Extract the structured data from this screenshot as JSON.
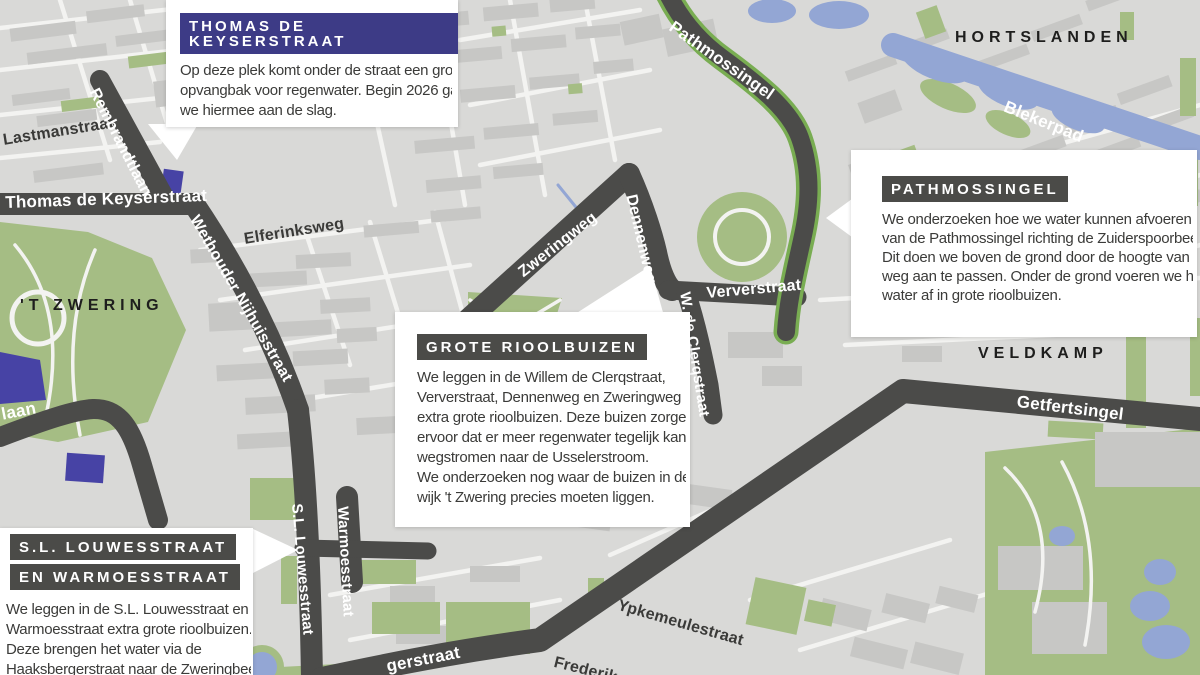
{
  "colors": {
    "map_background": "#d9d9d7",
    "buildings": "#c7c7c5",
    "streets_light": "#f3f3f1",
    "parks_green": "#a5bd84",
    "singel_edge_green": "#79ad52",
    "water_blue": "#93a6d4",
    "road_highlight_dark": "#4b4b49",
    "project_purple": "#4743a5",
    "header_navy": "#3d3b86",
    "header_gray": "#4b4b48",
    "body_text": "#3b3b39"
  },
  "districts": {
    "hortslanden": "HORTSLANDEN",
    "t_zwering": "'T ZWERING",
    "veldkamp": "VELDKAMP"
  },
  "street_labels": {
    "lastmanstraat": "Lastmanstraat",
    "rembrandtlaan": "Rembrandtlaan",
    "thomas_de_keyserstraat": "Thomas de Keyserstraat",
    "wethouder_nijhuisstraat": "Wethouder Nijhuisstraat",
    "elferinksweg": "Elferinksweg",
    "zweringweg": "Zweringweg",
    "dennenweg": "Dennenweg",
    "w_de_clerqstraat": "W. de Clerqstraat",
    "ververstraat": "Ververstraat",
    "pathmossingel": "Pathmossingel",
    "blekerpad": "Blekerpad",
    "getfertsingel": "Getfertsingel",
    "sl_louwesstraat": "S.L. Louwesstraat",
    "warmoesstraat": "Warmoesstraat",
    "ypkemeulestraat": "Ypkemeulestraat",
    "laan_fragment": "laan",
    "haaksbergerstraat_fragment": "gerstraat",
    "frederik_fragment": "Frederik"
  },
  "callouts": {
    "thomas": {
      "title": "THOMAS DE KEYSERSTRAAT",
      "body": "Op deze plek komt onder de straat een grote\nopvangbak voor regenwater. Begin 2026 gaan\nwe hiermee aan de slag."
    },
    "pathmossingel": {
      "title": "PATHMOSSINGEL",
      "body": "We onderzoeken hoe we water kunnen afvoeren\nvan de Pathmossingel richting de Zuiderspoorbeek.\nDit doen we boven de grond door de hoogte van de\nweg aan te passen. Onder de grond voeren we het\nwater af in grote rioolbuizen."
    },
    "grote_rioolbuizen": {
      "title": "GROTE RIOOLBUIZEN",
      "body": "We leggen in de Willem de Clerqstraat,\nVerverstraat, Dennenweg en Zweringweg\nextra grote rioolbuizen. Deze buizen zorgen\nervoor dat er meer regenwater tegelijk kan\nwegstromen naar de Usselerstroom.\nWe onderzoeken nog waar de buizen in de\nwijk 't Zwering precies moeten liggen."
    },
    "louwes": {
      "title_line1": "S.L. LOUWESSTRAAT",
      "title_line2": "EN WARMOESSTRAAT",
      "body": "We leggen in de S.L. Louwesstraat en\nWarmoesstraat extra grote rioolbuizen.\nDeze brengen het water via de\nHaaksbergerstraat naar de Zweringbeek"
    }
  }
}
